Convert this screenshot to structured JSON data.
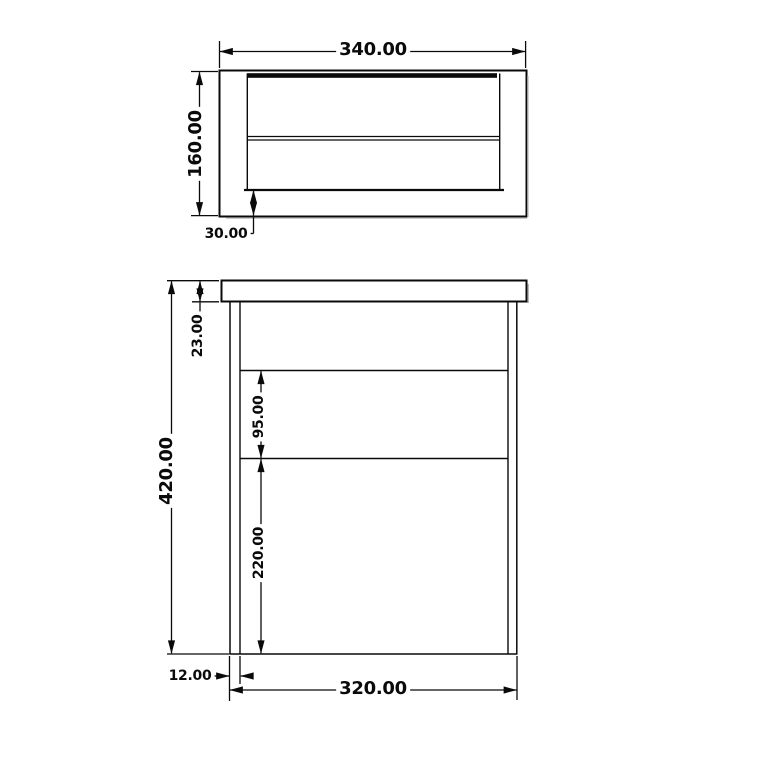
{
  "drawing_type": "furniture technical drawing, two orthographic views with dimensions",
  "colors": {
    "line": "#0a0a0a",
    "background": "#ffffff",
    "text": "#0a0a0a",
    "shadow": "#a0a0a0"
  },
  "views": {
    "plan": {
      "label": "top view",
      "dims": {
        "overall_width": "340.00",
        "overall_depth": "160.00",
        "front_offset": "30.00"
      }
    },
    "front": {
      "label": "front view",
      "dims": {
        "overall_height": "420.00",
        "top_panel_thickness": "23.00",
        "upper_shelf_spacing": "95.00",
        "lower_shelf_spacing": "220.00",
        "side_panel_thickness": "12.00",
        "inner_width": "320.00"
      }
    }
  }
}
